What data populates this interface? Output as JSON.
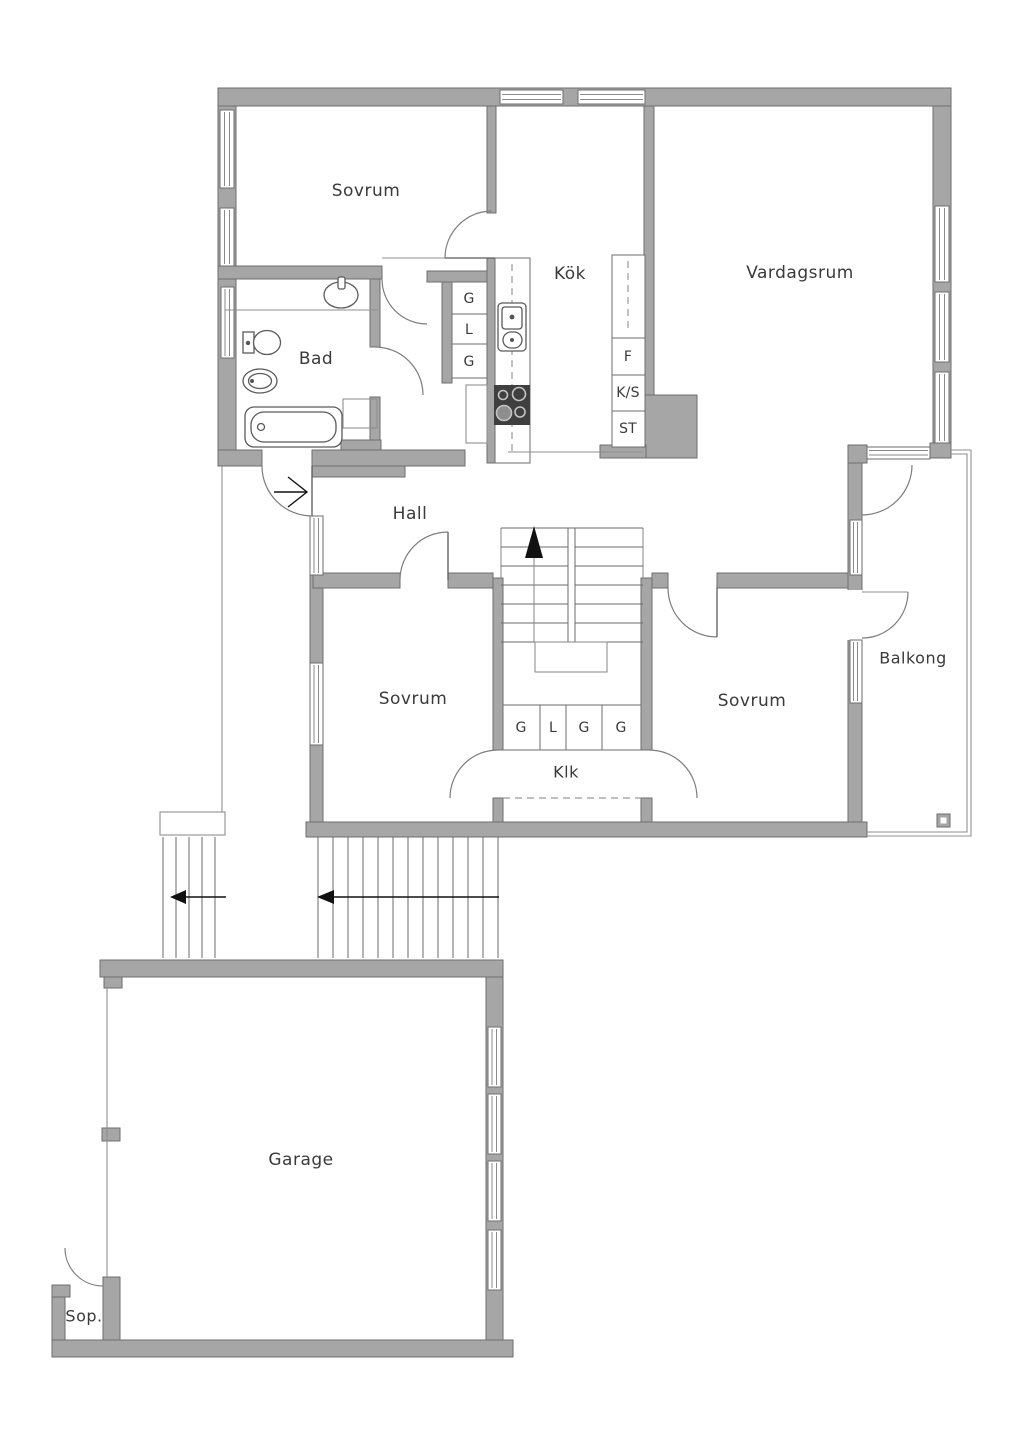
{
  "plan": {
    "type": "floor-plan",
    "rooms": {
      "bedroom_top": "Sovrum",
      "kitchen": "Kök",
      "living_room": "Vardagsrum",
      "bathroom": "Bad",
      "hall": "Hall",
      "bedroom_middle": "Sovrum",
      "bedroom_right": "Sovrum",
      "balcony": "Balkong",
      "walk_in_closet": "Klk",
      "garage": "Garage",
      "waste_room": "Sop."
    },
    "kitchen_cabinets": {
      "left_column": [
        "G",
        "L",
        "G"
      ],
      "right_column": [
        "F",
        "K/S",
        "ST"
      ]
    },
    "closet_cabinets": [
      "G",
      "L",
      "G",
      "G"
    ],
    "colors": {
      "wall": "#a6a6a6",
      "wall_outline": "#6e6e6e",
      "line": "#5a5a5a",
      "text": "#3a3a3a",
      "appliance_dark": "#3f3f3f"
    }
  }
}
